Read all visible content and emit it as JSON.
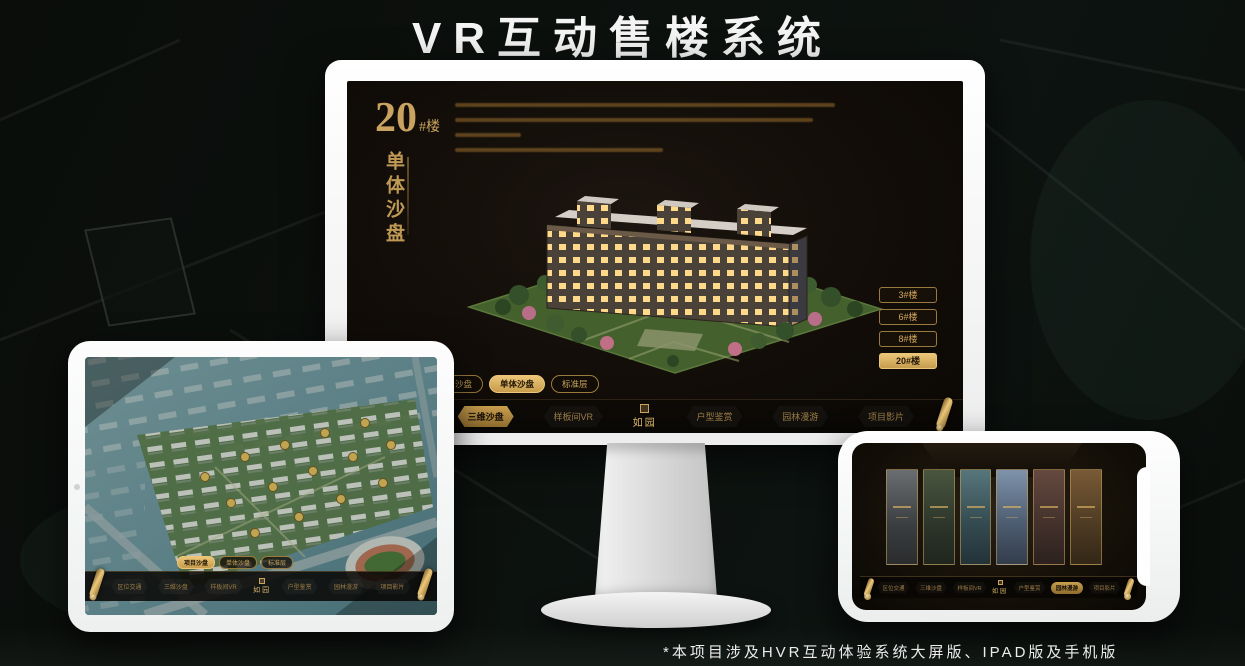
{
  "page": {
    "title": "VR互动售楼系统",
    "footnote": "*本项目涉及HVR互动体验系统大屏版、IPAD版及手机版"
  },
  "brand": {
    "logo": "如园",
    "gold": "#c9a35f",
    "gold_bright": "#e8c677",
    "screen_bg": "#130d08"
  },
  "monitor": {
    "building_no": "20",
    "building_no_suffix": "#楼",
    "building_subtitle": "单体沙盘",
    "floor_buttons": [
      {
        "label": "3#楼",
        "active": false
      },
      {
        "label": "6#楼",
        "active": false
      },
      {
        "label": "8#楼",
        "active": false
      },
      {
        "label": "20#楼",
        "active": true
      }
    ],
    "view_tabs": [
      {
        "label": "项目沙盘",
        "active": false
      },
      {
        "label": "单体沙盘",
        "active": true
      },
      {
        "label": "标准层",
        "active": false
      }
    ],
    "nav_items": [
      {
        "label": "区位交通",
        "active": false
      },
      {
        "label": "三维沙盘",
        "active": true
      },
      {
        "label": "样板间VR",
        "active": false
      },
      {
        "label": "户型鉴赏",
        "active": false
      },
      {
        "label": "园林漫游",
        "active": false
      },
      {
        "label": "项目影片",
        "active": false
      }
    ]
  },
  "ipad": {
    "view_tabs": [
      {
        "label": "项目沙盘",
        "active": true
      },
      {
        "label": "单体沙盘",
        "active": false
      },
      {
        "label": "标准层",
        "active": false
      }
    ],
    "nav_items": [
      {
        "label": "区位交通",
        "active": false
      },
      {
        "label": "三维沙盘",
        "active": false
      },
      {
        "label": "样板间VR",
        "active": false
      },
      {
        "label": "户型鉴赏",
        "active": false
      },
      {
        "label": "园林漫游",
        "active": false
      },
      {
        "label": "项目影片",
        "active": false
      }
    ]
  },
  "phone": {
    "nav_items": [
      {
        "label": "区位交通",
        "active": false
      },
      {
        "label": "三维沙盘",
        "active": false
      },
      {
        "label": "样板间VR",
        "active": false
      },
      {
        "label": "户型鉴赏",
        "active": false
      },
      {
        "label": "园林漫游",
        "active": true
      },
      {
        "label": "项目影片",
        "active": false
      }
    ]
  }
}
